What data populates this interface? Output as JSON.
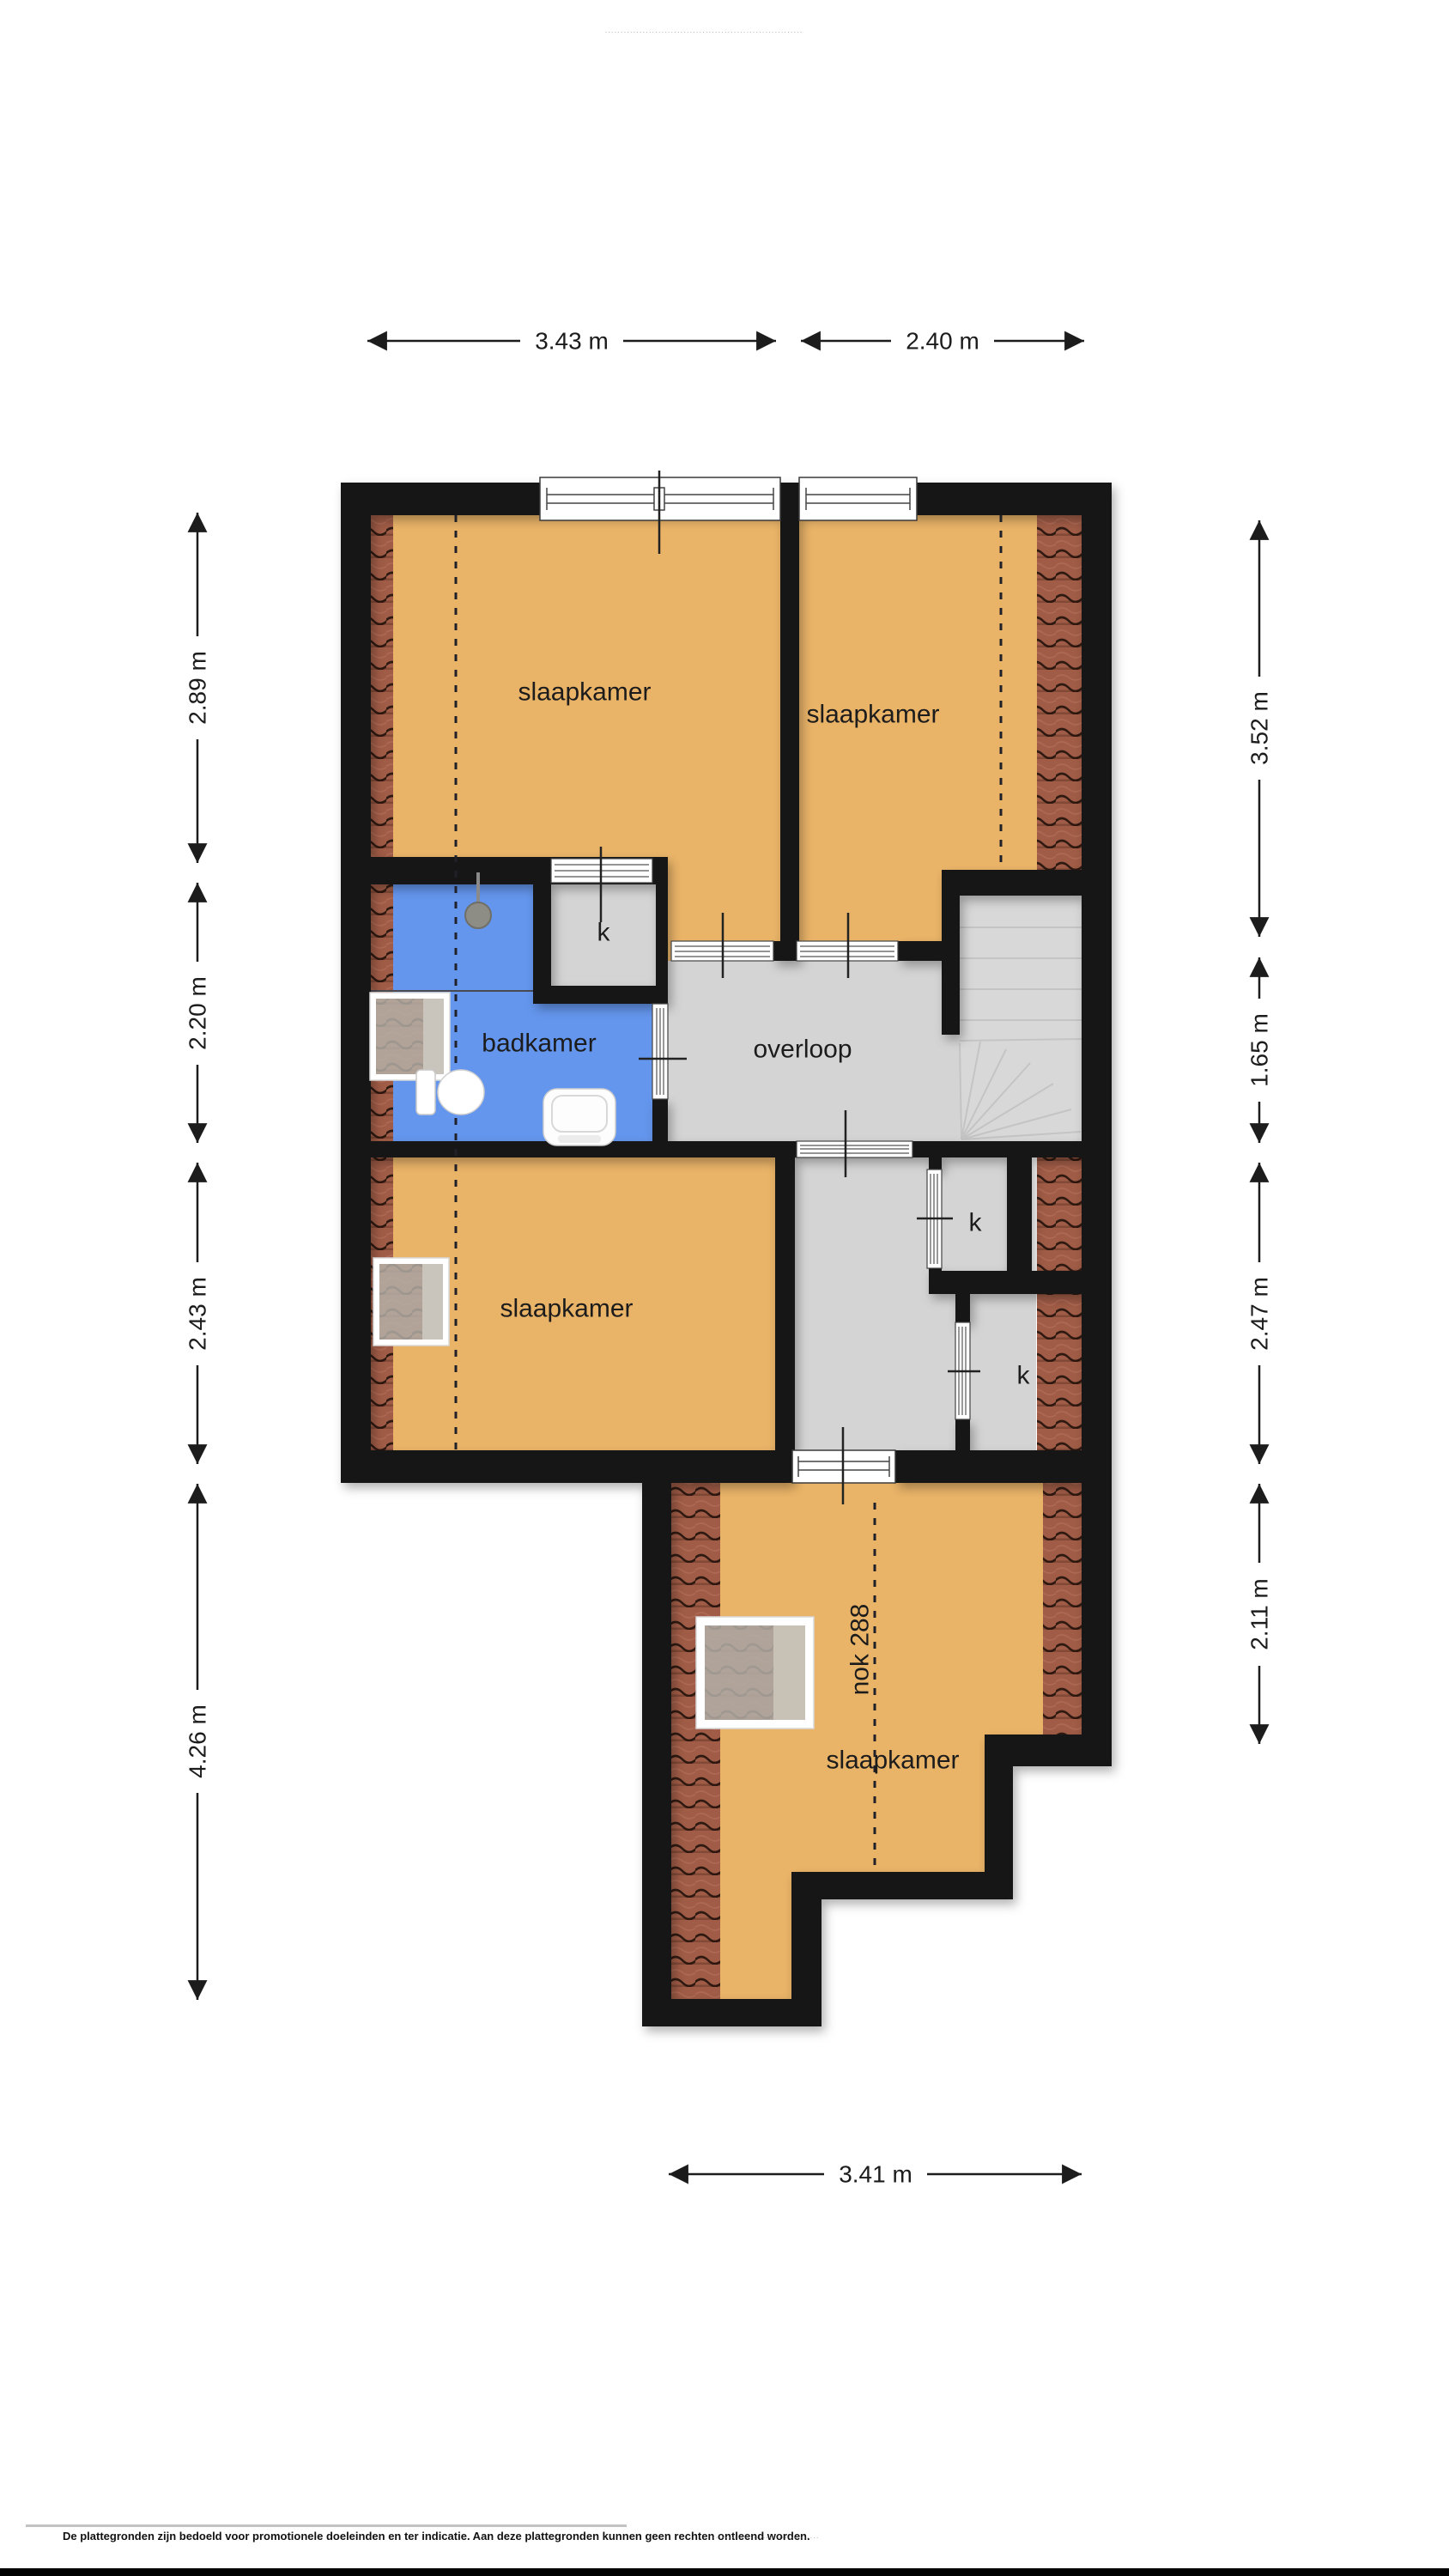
{
  "page": {
    "top_watermark": "·······························································",
    "footer": {
      "disclaimer": "De plattegronden zijn bedoeld voor promotionele doeleinden en ter indicatie. Aan deze plattegronden kunnen geen rechten ontleend worden.",
      "watermark": "··································"
    }
  },
  "colors": {
    "floor": "#eab468",
    "bath": "#6496ee",
    "hall": "#d4d4d4",
    "stairs": "#d8d8d8",
    "wall": "#161616",
    "roof_tile": "#a05c46",
    "background": "#ffffff"
  },
  "rooms": {
    "bedroom_top_left": {
      "label": "slaapkamer"
    },
    "bedroom_top_right": {
      "label": "slaapkamer"
    },
    "bathroom": {
      "label": "badkamer"
    },
    "landing": {
      "label": "overloop"
    },
    "bedroom_mid_left": {
      "label": "slaapkamer"
    },
    "bedroom_bottom": {
      "label": "slaapkamer"
    },
    "ridge": {
      "label": "nok 288"
    },
    "closet_top": {
      "label": "k"
    },
    "closet_mid": {
      "label": "k"
    },
    "closet_bottom": {
      "label": "k"
    }
  },
  "dimensions": {
    "top": [
      {
        "label": "3.43 m"
      },
      {
        "label": "2.40 m"
      }
    ],
    "left": [
      {
        "label": "2.89 m"
      },
      {
        "label": "2.20 m"
      },
      {
        "label": "2.43 m"
      },
      {
        "label": "4.26 m"
      }
    ],
    "right": [
      {
        "label": "3.52 m"
      },
      {
        "label": "1.65 m"
      },
      {
        "label": "2.47 m"
      },
      {
        "label": "2.11 m"
      }
    ],
    "bottom": [
      {
        "label": "3.41 m"
      }
    ]
  }
}
